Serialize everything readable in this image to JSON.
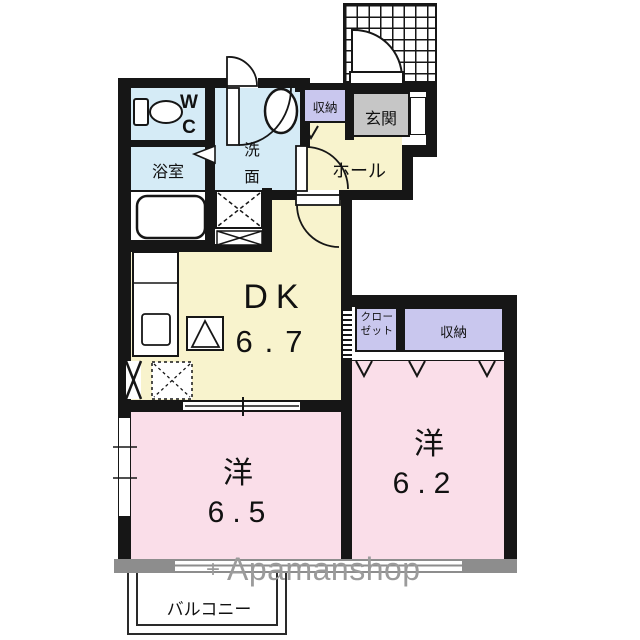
{
  "rooms": {
    "wc": {
      "label": "WC"
    },
    "bathroom": {
      "label": "浴室"
    },
    "washroom": {
      "label": "洗面"
    },
    "hall": {
      "label": "ホール"
    },
    "entrance": {
      "label": "玄関"
    },
    "entrance_storage": {
      "label": "収納"
    },
    "dining_kitchen": {
      "label": "DK",
      "size": "6.7"
    },
    "closet": {
      "label": "クローゼット"
    },
    "bedroom_storage": {
      "label": "収納"
    },
    "bedroom_west": {
      "label": "洋",
      "size": "6.5"
    },
    "bedroom_east": {
      "label": "洋",
      "size": "6.2"
    },
    "balcony": {
      "label": "バルコニー"
    }
  },
  "watermark": {
    "symbol": "+",
    "text": "Apamanshop"
  },
  "colors": {
    "wet_area": "#d5ebf6",
    "living": "#f8f3cd",
    "bedroom": "#fadee9",
    "storage": "#c9c7ee",
    "entrance_floor": "#c6c6c6",
    "wall": "#161616",
    "window_band": "#8d8d8d",
    "watermark_gray": "#9b9b9b"
  }
}
